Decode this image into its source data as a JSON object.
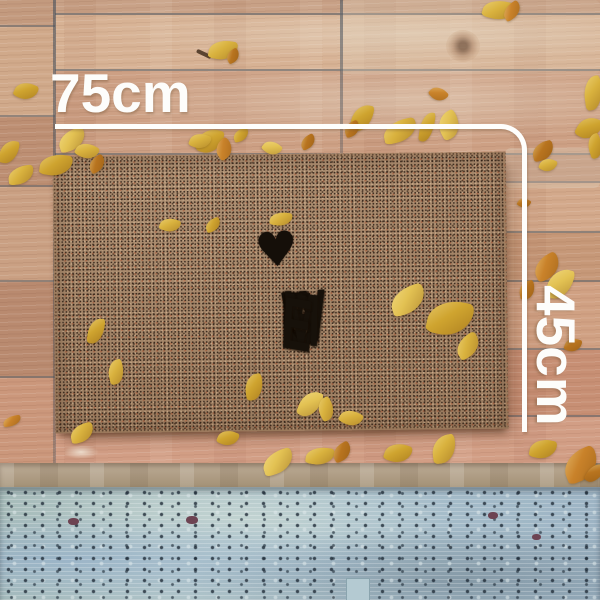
{
  "scene": {
    "type": "product-photo",
    "subject": "coir WELCOME doormat on rustic wooden deck with scattered autumn leaves",
    "doormat": {
      "word": "WELCOME",
      "heart_icon": "♥"
    },
    "annotation": {
      "width_label": "75cm",
      "height_label": "45cm",
      "color": "#ffffff"
    },
    "palette": {
      "mat_base": "#a5866a",
      "mat_print": "#17110a",
      "wood_warm": "#d2a084",
      "wood_seam": "#5c666f",
      "step_strip": "#b3a28e",
      "painted_wood_blue": "#aec2c8",
      "leaf_yellow": "#d9b23e",
      "leaf_orange": "#c9822a"
    },
    "leaves": [
      {
        "x": 483,
        "y": 0,
        "w": 32,
        "h": 20,
        "r": 15,
        "c": "#d9b23e"
      },
      {
        "x": 502,
        "y": 4,
        "w": 20,
        "h": 14,
        "r": -35,
        "c": "#c9822a"
      },
      {
        "x": 209,
        "y": 40,
        "w": 28,
        "h": 20,
        "r": 10,
        "c": "#d9b23e"
      },
      {
        "x": 226,
        "y": 50,
        "w": 14,
        "h": 12,
        "r": -30,
        "c": "#b8741f"
      },
      {
        "x": 15,
        "y": 82,
        "w": 22,
        "h": 18,
        "r": 25,
        "c": "#cfa42f"
      },
      {
        "x": 584,
        "y": 76,
        "w": 18,
        "h": 34,
        "r": -8,
        "c": "#d9b23e"
      },
      {
        "x": 578,
        "y": 116,
        "w": 22,
        "h": 24,
        "r": 28,
        "c": "#cfa42f"
      },
      {
        "x": 430,
        "y": 87,
        "w": 17,
        "h": 14,
        "r": 45,
        "c": "#c9822a"
      },
      {
        "x": 420,
        "y": 112,
        "w": 14,
        "h": 30,
        "r": 8,
        "c": "#cfa42f"
      },
      {
        "x": 438,
        "y": 112,
        "w": 22,
        "h": 26,
        "r": -28,
        "c": "#e3c253"
      },
      {
        "x": 383,
        "y": 120,
        "w": 34,
        "h": 22,
        "r": -12,
        "c": "#d9b23e"
      },
      {
        "x": 352,
        "y": 104,
        "w": 20,
        "h": 28,
        "r": 14,
        "c": "#cfa42f"
      },
      {
        "x": 344,
        "y": 122,
        "w": 16,
        "h": 14,
        "r": -22,
        "c": "#b8741f"
      },
      {
        "x": 198,
        "y": 128,
        "w": 24,
        "h": 26,
        "r": 18,
        "c": "#cfa42f"
      },
      {
        "x": 215,
        "y": 140,
        "w": 18,
        "h": 18,
        "r": -38,
        "c": "#c9822a"
      },
      {
        "x": 58,
        "y": 130,
        "w": 28,
        "h": 20,
        "r": -18,
        "c": "#e3c253"
      },
      {
        "x": 76,
        "y": 143,
        "w": 22,
        "h": 16,
        "r": 28,
        "c": "#d9b23e"
      },
      {
        "x": 40,
        "y": 154,
        "w": 32,
        "h": 22,
        "r": 8,
        "c": "#cfa42f"
      },
      {
        "x": 88,
        "y": 157,
        "w": 18,
        "h": 14,
        "r": -32,
        "c": "#b8741f"
      },
      {
        "x": 8,
        "y": 166,
        "w": 26,
        "h": 18,
        "r": -8,
        "c": "#d9b23e"
      },
      {
        "x": 0,
        "y": 140,
        "w": 18,
        "h": 24,
        "r": 12,
        "c": "#cfa42f"
      },
      {
        "x": 190,
        "y": 133,
        "w": 20,
        "h": 16,
        "r": 22,
        "c": "#d9b23e"
      },
      {
        "x": 233,
        "y": 129,
        "w": 16,
        "h": 12,
        "r": -18,
        "c": "#cfa42f"
      },
      {
        "x": 263,
        "y": 141,
        "w": 18,
        "h": 14,
        "r": 38,
        "c": "#e3c253"
      },
      {
        "x": 300,
        "y": 136,
        "w": 16,
        "h": 12,
        "r": -28,
        "c": "#b8741f"
      },
      {
        "x": 532,
        "y": 142,
        "w": 22,
        "h": 18,
        "r": -15,
        "c": "#b8741f"
      },
      {
        "x": 540,
        "y": 158,
        "w": 16,
        "h": 14,
        "r": 25,
        "c": "#d9b23e"
      },
      {
        "x": 588,
        "y": 134,
        "w": 14,
        "h": 24,
        "r": -18,
        "c": "#cfa42f"
      },
      {
        "x": 518,
        "y": 198,
        "w": 12,
        "h": 10,
        "r": 30,
        "c": "#b8741f"
      },
      {
        "x": 160,
        "y": 218,
        "w": 20,
        "h": 14,
        "r": 18,
        "c": "#d9b23e"
      },
      {
        "x": 205,
        "y": 219,
        "w": 16,
        "h": 12,
        "r": -22,
        "c": "#cfa42f"
      },
      {
        "x": 270,
        "y": 212,
        "w": 22,
        "h": 14,
        "r": 8,
        "c": "#d9b23e"
      },
      {
        "x": 533,
        "y": 256,
        "w": 28,
        "h": 22,
        "r": -28,
        "c": "#c9822a"
      },
      {
        "x": 548,
        "y": 268,
        "w": 24,
        "h": 32,
        "r": 16,
        "c": "#e3c253"
      },
      {
        "x": 519,
        "y": 281,
        "w": 16,
        "h": 18,
        "r": -12,
        "c": "#b8741f"
      },
      {
        "x": 88,
        "y": 318,
        "w": 16,
        "h": 26,
        "r": 8,
        "c": "#cfa42f"
      },
      {
        "x": 108,
        "y": 360,
        "w": 16,
        "h": 24,
        "r": -14,
        "c": "#d9b23e"
      },
      {
        "x": 390,
        "y": 287,
        "w": 36,
        "h": 26,
        "r": -18,
        "c": "#e3c253"
      },
      {
        "x": 428,
        "y": 300,
        "w": 44,
        "h": 36,
        "r": 12,
        "c": "#cfa42f"
      },
      {
        "x": 455,
        "y": 336,
        "w": 26,
        "h": 20,
        "r": -32,
        "c": "#d9b23e"
      },
      {
        "x": 565,
        "y": 338,
        "w": 16,
        "h": 14,
        "r": 18,
        "c": "#b8741f"
      },
      {
        "x": 245,
        "y": 374,
        "w": 18,
        "h": 26,
        "r": -8,
        "c": "#cfa42f"
      },
      {
        "x": 300,
        "y": 390,
        "w": 20,
        "h": 28,
        "r": 22,
        "c": "#e3c253"
      },
      {
        "x": 318,
        "y": 398,
        "w": 16,
        "h": 22,
        "r": -28,
        "c": "#d9b23e"
      },
      {
        "x": 340,
        "y": 410,
        "w": 22,
        "h": 16,
        "r": 28,
        "c": "#d9b23e"
      },
      {
        "x": 3,
        "y": 416,
        "w": 18,
        "h": 10,
        "r": -10,
        "c": "#c9822a"
      },
      {
        "x": 70,
        "y": 424,
        "w": 24,
        "h": 18,
        "r": -14,
        "c": "#d9b23e"
      },
      {
        "x": 218,
        "y": 430,
        "w": 20,
        "h": 16,
        "r": 22,
        "c": "#cfa42f"
      },
      {
        "x": 262,
        "y": 451,
        "w": 32,
        "h": 22,
        "r": -18,
        "c": "#e3c253"
      },
      {
        "x": 306,
        "y": 447,
        "w": 28,
        "h": 18,
        "r": 8,
        "c": "#d9b23e"
      },
      {
        "x": 332,
        "y": 444,
        "w": 20,
        "h": 16,
        "r": -28,
        "c": "#b8741f"
      },
      {
        "x": 385,
        "y": 443,
        "w": 26,
        "h": 20,
        "r": 18,
        "c": "#cfa42f"
      },
      {
        "x": 432,
        "y": 435,
        "w": 24,
        "h": 28,
        "r": -8,
        "c": "#d9b23e"
      },
      {
        "x": 530,
        "y": 439,
        "w": 26,
        "h": 20,
        "r": 12,
        "c": "#cfa42f"
      },
      {
        "x": 563,
        "y": 450,
        "w": 36,
        "h": 30,
        "r": -22,
        "c": "#c9822a"
      },
      {
        "x": 588,
        "y": 462,
        "w": 14,
        "h": 22,
        "r": 32,
        "c": "#b8741f"
      }
    ]
  }
}
